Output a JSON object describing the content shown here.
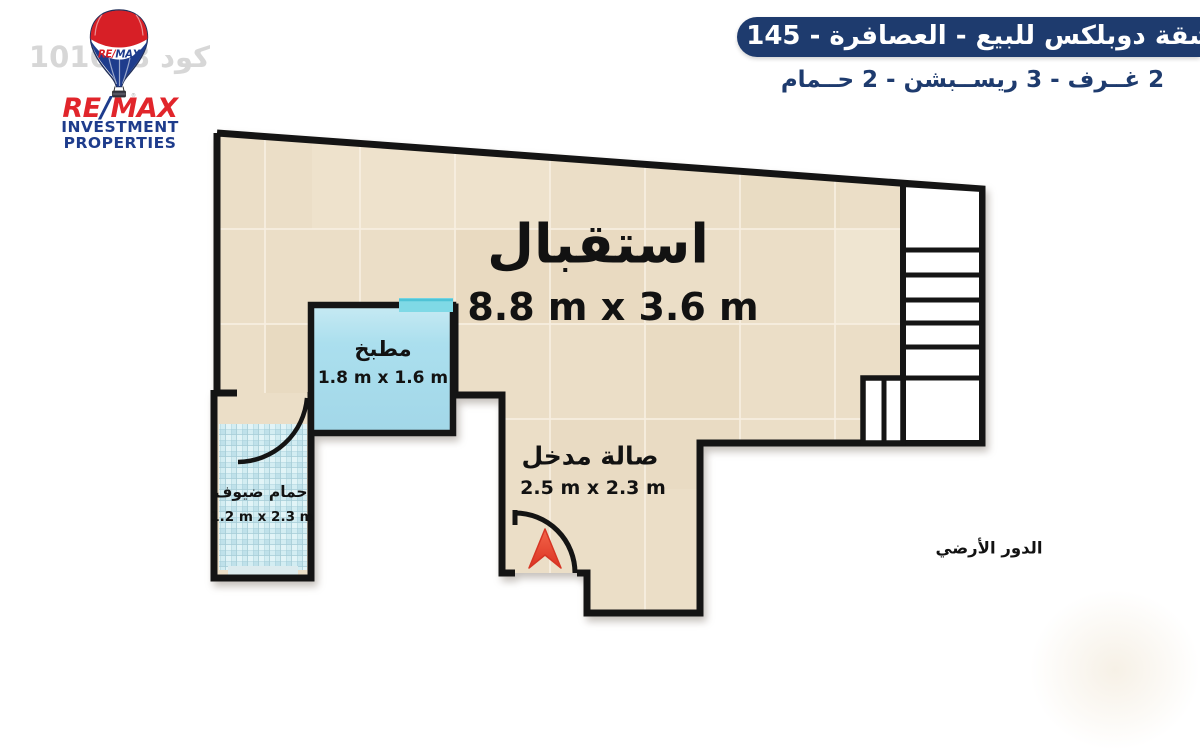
{
  "header": {
    "title": "شقة دوبلكس للبيع - العصافرة - 145 م",
    "subtitle": "2 غــرف - 3 ريســبشن - 2 حــمام"
  },
  "logo": {
    "brand_re": "RE",
    "brand_slash": "/",
    "brand_max": "MAX",
    "line1": "INVESTMENT",
    "line2": "PROPERTIES",
    "registered_mark": "®"
  },
  "watermark": {
    "code_text": "كود 101668"
  },
  "plan": {
    "floor_label": "الدور الأرضي",
    "rooms": {
      "reception": {
        "name": "استقبال",
        "dims": "8.8 m x 3.6 m"
      },
      "kitchen": {
        "name": "مطبخ",
        "dims": "1.8 m x 1.6 m"
      },
      "guest_bath": {
        "name": "حمام ضيوف",
        "dims": "1.2 m x 2.3 m"
      },
      "entry_hall": {
        "name": "صالة مدخل",
        "dims": "2.5 m x 2.3 m"
      }
    },
    "colors": {
      "floor_beige": "#ebdec7",
      "kitchen_blue": "#a9dcec",
      "bath_tile_blue": "#cfeaf0",
      "wall_black": "#141414",
      "header_navy": "#1e3b6e",
      "brand_red": "#e1252b",
      "brand_blue": "#1e3c8c",
      "entry_arrow_red": "#e8432f"
    }
  }
}
